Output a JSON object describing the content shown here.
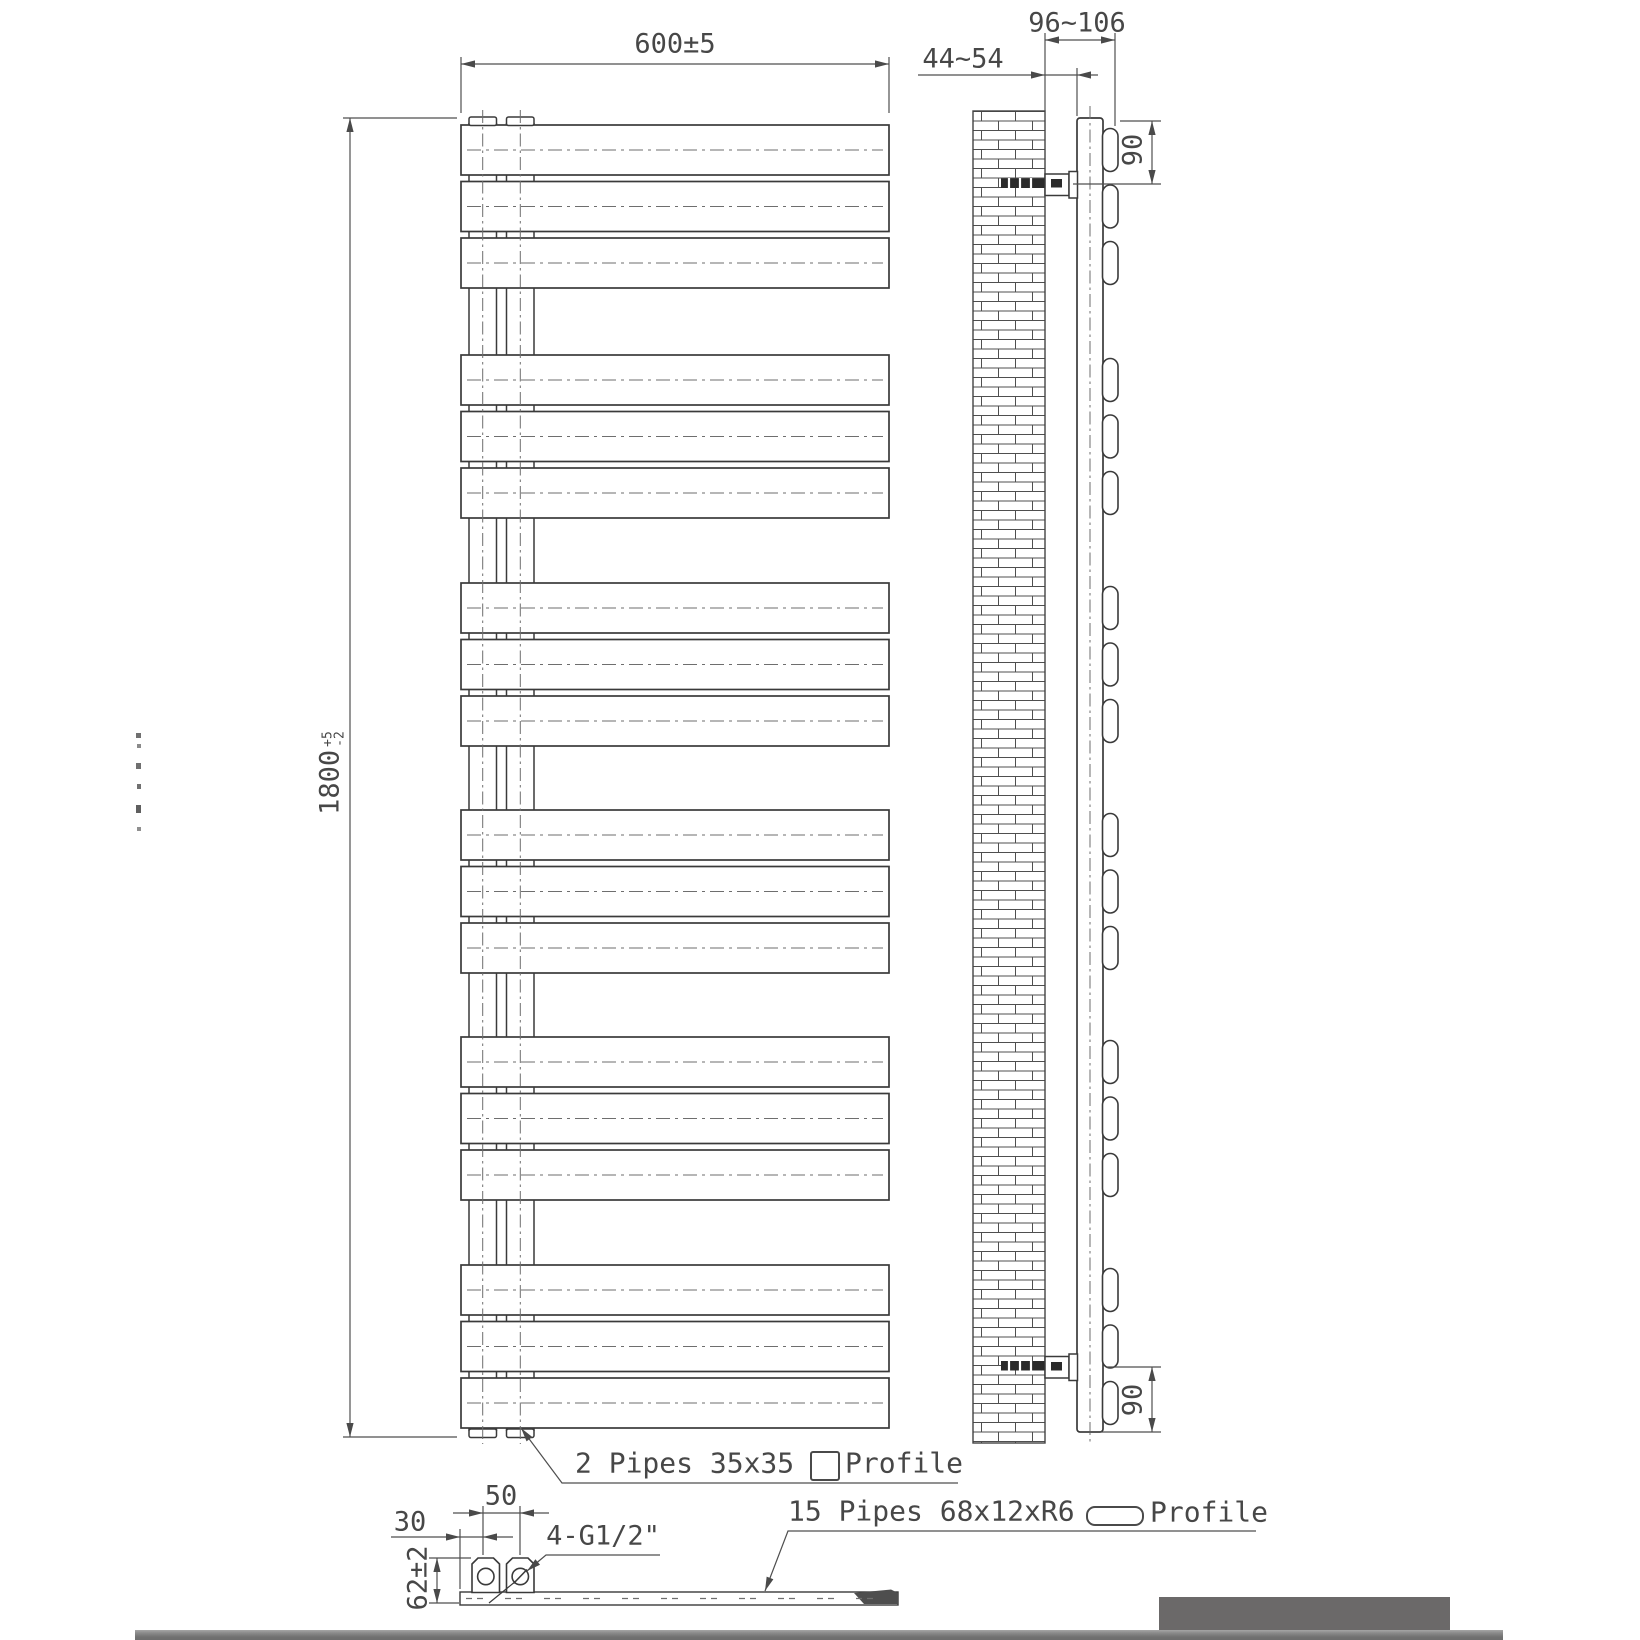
{
  "title": "Towel radiator technical drawing",
  "dimensions": {
    "width": "600±5",
    "height_main": "1800",
    "height_tol_plus": "+5",
    "height_tol_minus": "-2",
    "wall_to_back": "44~54",
    "wall_to_front": "96~106",
    "top_bracket_offset": "90",
    "bottom_bracket_offset": "90",
    "pipe_center_spacing": "50",
    "pipe_edge_offset": "30",
    "connection_height": "62±2",
    "connections_label": "4-G1/2\""
  },
  "notes": {
    "vertical_pipes": "2 Pipes 35x35",
    "vertical_pipes_profile": "Profile",
    "horizontal_pipes": "15 Pipes 68x12xR6",
    "horizontal_pipes_profile": "Profile"
  },
  "drawing": {
    "front_panel_groups": 6,
    "panels_per_group": 3,
    "colors": {
      "line": "#3a3a3a",
      "dim": "#4f4f4f",
      "centerline": "#6e6e6e",
      "footer_bar": "#7a7a7a",
      "footer_block": "#6b6969"
    }
  }
}
